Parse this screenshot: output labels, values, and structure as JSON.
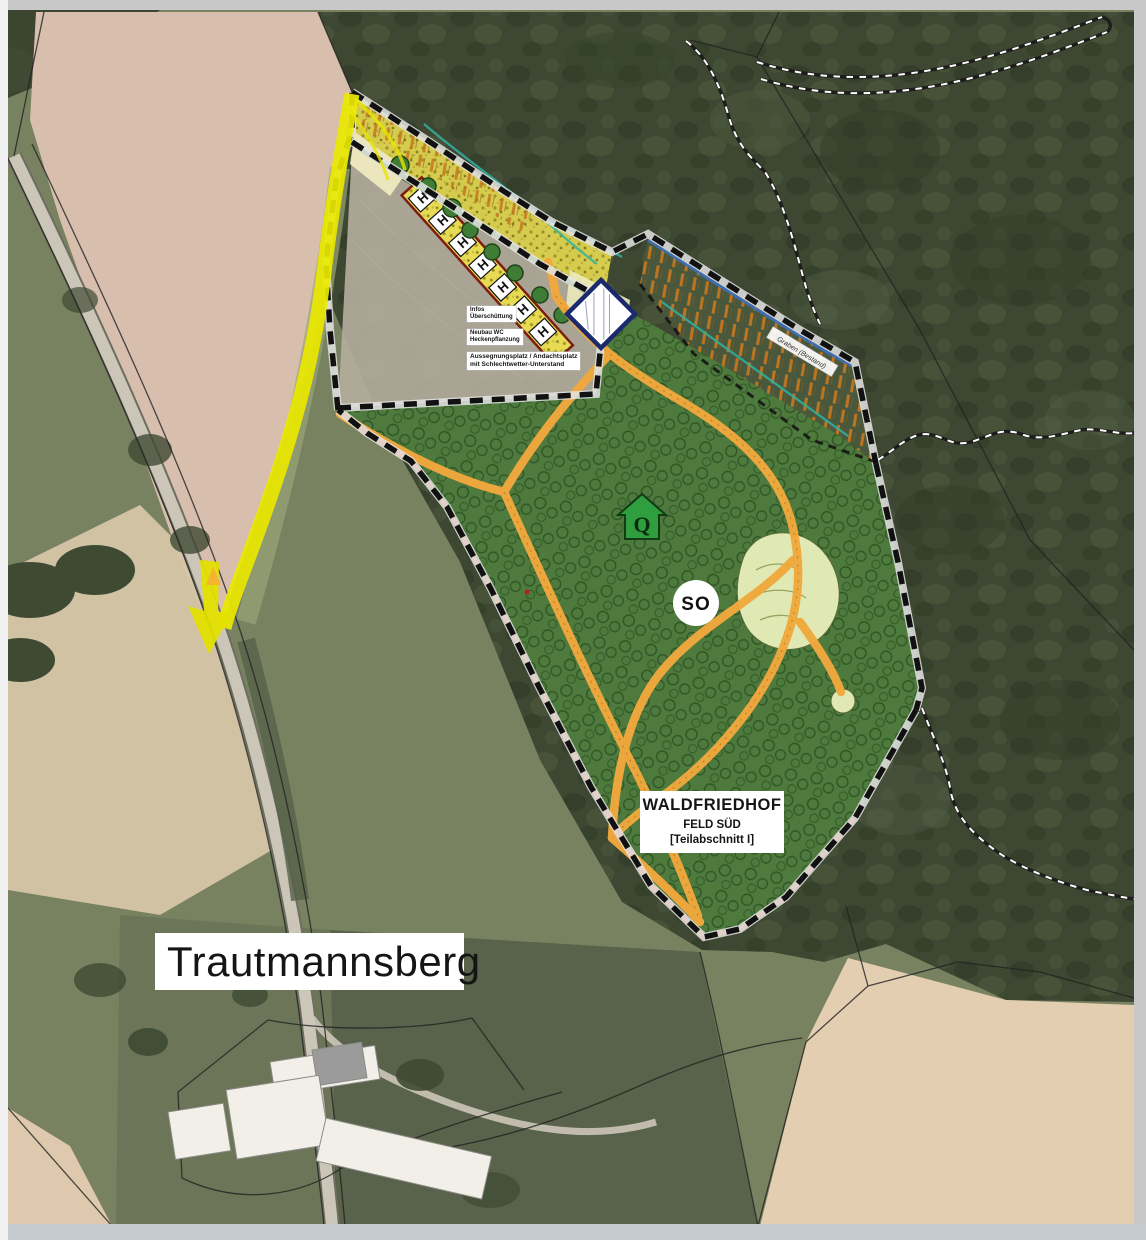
{
  "labels": {
    "place_name": "Trautmannsberg",
    "area_box": {
      "line1": "WALDFRIEDHOF",
      "line2": "FELD SÜD",
      "line3": "[Teilabschnitt I]"
    },
    "notes": [
      {
        "line1": "Infos",
        "line2": "Überschüttung"
      },
      {
        "line1": "Neubau WC",
        "line2": "Heckenpflanzung"
      },
      {
        "line1": "Aussegnungsplatz / Andachtsplatz",
        "line2": "mit Schlechtwetter-Unterstand"
      }
    ],
    "edge_label": "Graben (Bestand)"
  },
  "markers": {
    "so_badge": "SO",
    "quelle": "Q",
    "parking_symbol": "H"
  },
  "colors": {
    "highlight_yellow": "#eae800",
    "path_orange": "#f1a93d",
    "cemetery_green": "#4f7a3d",
    "boundary_edging_red": "#e2622d",
    "parking_border_red": "#7d1d12",
    "diamond_navy": "#1b2a6e",
    "marker_green": "#2f9e3f"
  }
}
